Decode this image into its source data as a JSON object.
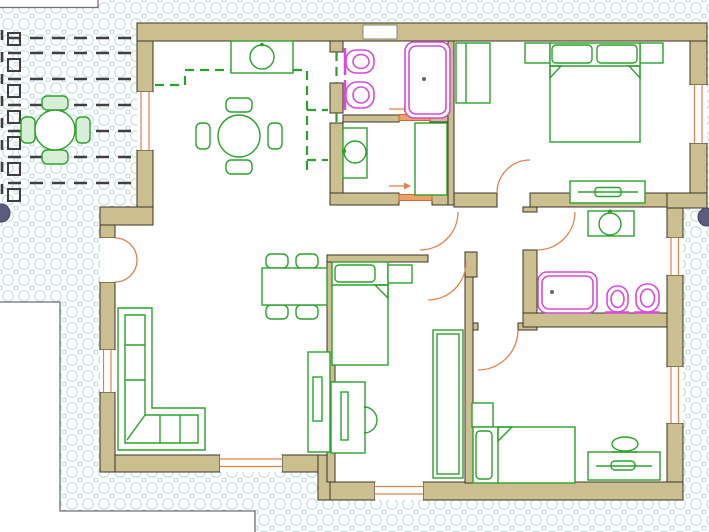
{
  "title": "apartment-floor-plan",
  "palette": {
    "wall_fill": "#cbbf90",
    "wall_edge": "#3a3426",
    "green": "#2ba12b",
    "green_light": "#d7eed7",
    "magenta": "#d94ad9",
    "orange": "#e0824c",
    "pattern": "#b9dcda",
    "pergola": "#3f3f3f",
    "neighbor": "#6f6f6f",
    "marker": "#5c5c80",
    "paper": "#ffffff",
    "dot": "#666666"
  },
  "icon_names": [
    "patio-table-icon",
    "patio-chair-icon",
    "pergola-beam-icon",
    "pergola-post-icon",
    "kitchen-counter-icon",
    "kitchen-sink-icon",
    "wall-cabinet-dashed-icon",
    "round-dining-table-icon",
    "dining-table-icon",
    "chair-icon",
    "corner-sofa-icon",
    "shelf-icon",
    "double-bed-icon",
    "single-bed-icon",
    "pillow-icon",
    "nightstand-icon",
    "wardrobe-icon",
    "dresser-icon",
    "desk-icon",
    "desk-chair-icon",
    "vanity-mirror-icon",
    "bidet-icon",
    "toilet-icon",
    "bathtub-icon",
    "washbasin-icon",
    "laundry-cabinet-icon",
    "door-arc-icon",
    "double-entry-door-icon",
    "sliding-door-icon",
    "door-direction-arrow-icon",
    "window-icon",
    "survey-marker-icon"
  ]
}
